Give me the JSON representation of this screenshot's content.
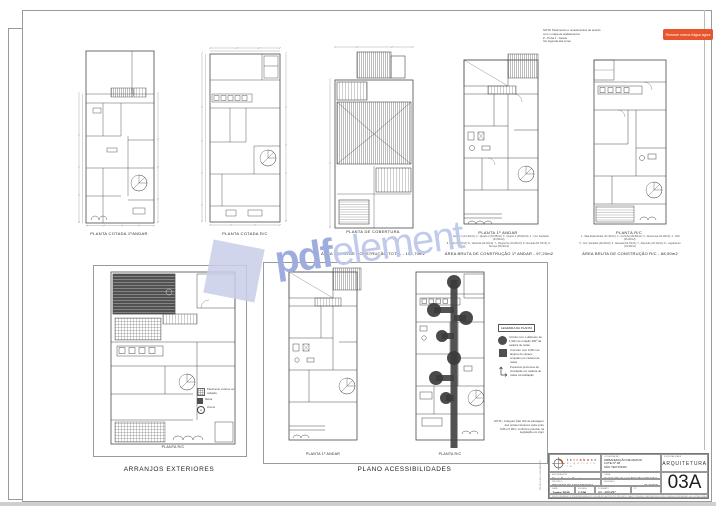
{
  "badge": {
    "label": "Remover marca d'água agora"
  },
  "watermark": {
    "bold": "pdf",
    "light": "element"
  },
  "nota_plan4": {
    "l1": "NOTA: Pavimentos e revestimentos de acordo",
    "l2": "com o mapa de acabamentos",
    "l3": "P - Porta    J - Janela",
    "l4": "Ver legenda das cores"
  },
  "top_plans": {
    "p1": {
      "caption": "PLANTA COTADA 1ºANDAR"
    },
    "p2": {
      "caption": "PLANTA COTADA R/C"
    },
    "p3": {
      "caption": "PLANTA DE COBERTURA",
      "area": "ÁREA BRUTA DE CONSTRUÇÃO TOTAL  -  198,70m2"
    },
    "p4": {
      "caption": "PLANTA 1º ANDAR",
      "legend1": "1 - Quarto 1 (12,40m2);  2 - Quarto 2 (10,85m2);  3 - Quarto 3 (09,60m2);  4 - Inst. Sanitária (04,50m2);",
      "legend2": "5 - Hall (03,20m2);  6 - Varanda (02,40m2);  7 - Roupeiros (01,80m2);  8 - Escada (04,70m2);  9 - Terraço (08,30m2)",
      "area": "ÁREA BRUTA DE CONSTRUÇÃO 1º ANDAR  -  97,20m2"
    },
    "p5": {
      "caption": "PLANTA R/C",
      "legend1": "1 - Sala Estar/Jantar (21,40m2);  2 - Cozinha (09,80m2);  3 - Despensa (01,90m2);  4 - Hall (05,20m2);",
      "legend2": "5 - Inst. Sanitária (02,30m2);  6 - Escada (04,70m2);  7 - Alpendre (03,10m2);  8 - Logradouro (22,60m2)",
      "area": "ÁREA BRUTA DE CONSTRUÇÃO R/C  -  88,50m2"
    }
  },
  "bottom": {
    "arranjos": {
      "title": "ARRANJOS EXTERIORES",
      "plan_caption": "PLANTA R/C",
      "legend": [
        {
          "label": "Pavimento exterior em calçada"
        },
        {
          "label": "Relva"
        },
        {
          "label": "Árvore"
        }
      ],
      "tree_glyph": "A"
    },
    "acess": {
      "title": "PLANO ACESSIBILIDADES",
      "plan1_caption": "PLANTA 1º ANDAR",
      "plan2_caption": "PLANTA R/C",
      "legend_title": "LEGENDA DA PLANTA",
      "legend": [
        {
          "label": "Círculo com o diâmetro de 1,50m de rotação 360º da cadeira de rodas"
        },
        {
          "label": "Corredor com 0,90m de largura do espaço ocupado por cadeira de rodas"
        },
        {
          "label": "Possíveis percursos de circulação em cadeira de rodas na habitação"
        }
      ],
      "note1": "NOTA - A largura (vão útil) de passagem das portas interiores varia entre",
      "note2": "0,80 e 0,90m, conforme previsto na legislação em vigor"
    }
  },
  "titleblock": {
    "side_text": "PROJETO DE LICENCIAMENTO",
    "logo_line1": "t e r r a b a s e",
    "logo_line2": "a r q u i t e t u r a",
    "obra_label": "LOCALIZAÇÃO",
    "obra_line1": "URBANIZAÇÃO DE MATOS",
    "obra_line2": "LOTE Nº 48",
    "obra_line3": "SÃO TEOTÓNIO",
    "esp_label": "ESPECIALIDADE",
    "esp_value": "ARQUITETURA",
    "req_label": "REQUERENTE",
    "req_value": "Maria Duarte Ferreira",
    "obra2_label": "OBRA",
    "obra2_value": "Construção de uma Moradia Unifamiliar",
    "proj_label": "PROJETO",
    "proj_value": "PROJETO DE ARQUITETURA",
    "des_label": "DESENHO",
    "des_value": "PLANTAS",
    "data_label": "DATA",
    "data_value": "Junho 2020",
    "esc_label": "ESCALA",
    "esc_value": "1:100",
    "fmt_label": "FORMATO",
    "fmt_value": "A3 - 420x297",
    "num_label": "Nº",
    "sheet_number": "03A",
    "disclaimer": "ESTE DESENHO É PROPRIEDADE EXCLUSIVA DO AUTOR DO PROJETO, NÃO PODENDO SER REPRODUZIDO SEM AUTORIZAÇÃO. AS COTAS PREVALECEM SOBRE A ESCALA DO DESENHO."
  }
}
